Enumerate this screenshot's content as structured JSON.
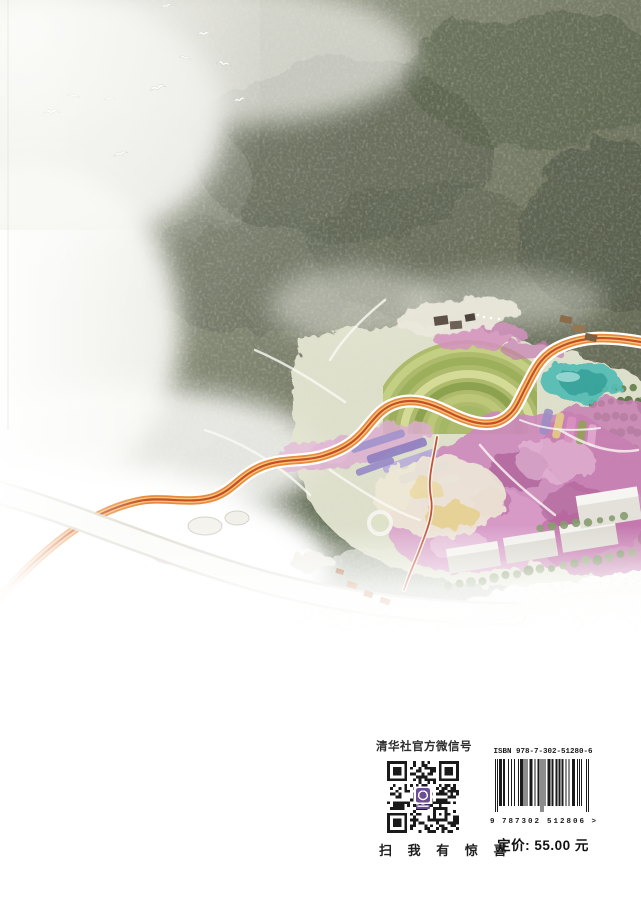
{
  "page": {
    "background": "#ffffff"
  },
  "artwork": {
    "name": "aerial-masterplan-rendering",
    "accent_colors": {
      "forest": "#6e7462",
      "trail_orange": "#d2622a",
      "blossom_pink": "#cd8abc",
      "pond_teal": "#57bdb3",
      "lavender": "#9b8ec4"
    }
  },
  "wechat": {
    "label": "清华社官方微信号",
    "scan_hint": "扫 我 有 惊 喜",
    "qr_logo_color": "#6a4f93"
  },
  "isbn": {
    "label": "ISBN 978-7-302-51280-6",
    "barcode_number": "9787302512806",
    "digit_left": "9",
    "digit_group1": "787302",
    "digit_group2": "512806",
    "tail": ">",
    "price": "定价: 55.00 元"
  }
}
